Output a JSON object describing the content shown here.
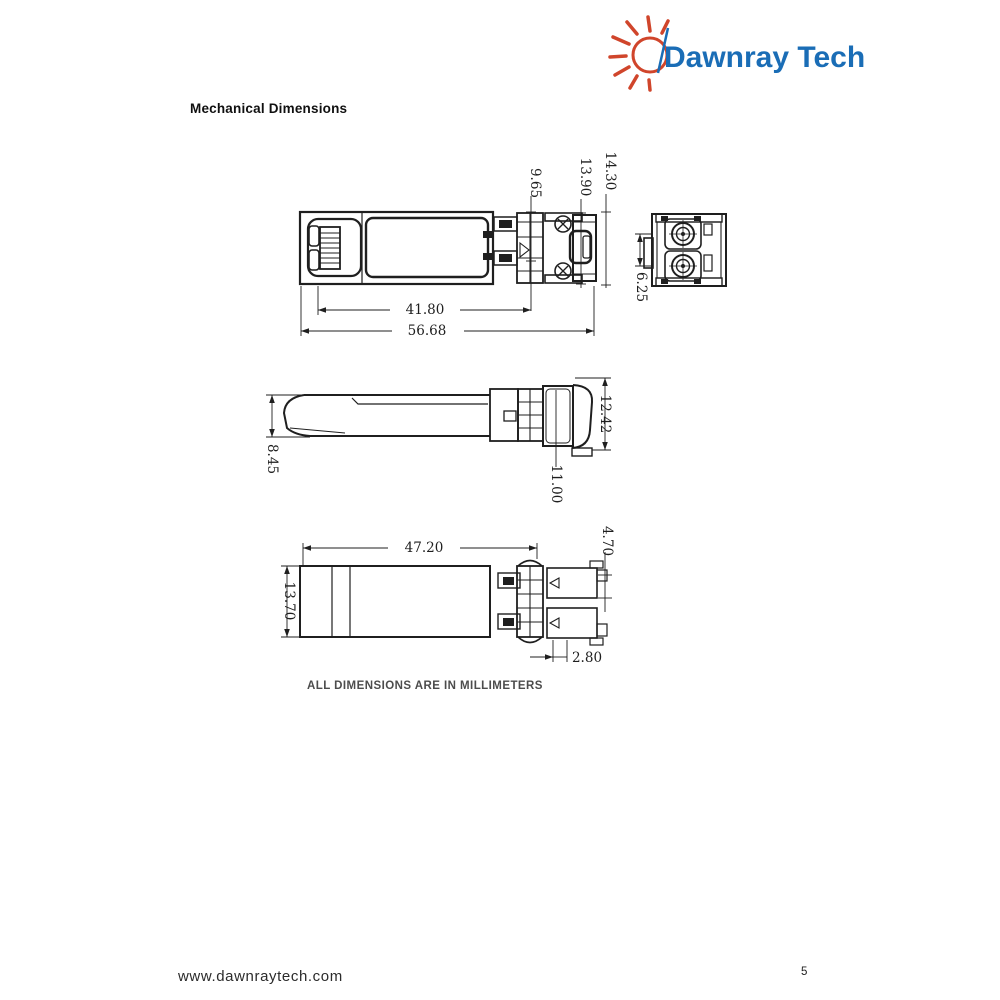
{
  "logo": {
    "brand": "Dawnray Tech"
  },
  "heading": "Mechanical Dimensions",
  "note": "ALL DIMENSIONS ARE IN MILLIMETERS",
  "footer": {
    "url": "www.dawnraytech.com",
    "page_number": "5"
  },
  "colors": {
    "brand_blue": "#1a6db6",
    "sun_red": "#d0452b",
    "drawing_line": "#1f1f1f"
  },
  "views": {
    "top": {
      "dim_front_length": "41.80",
      "dim_overall_length": "56.68",
      "dim_pad_height": "9.65",
      "dim_body_height": "13.90",
      "dim_overall_height": "14.30"
    },
    "rear": {
      "dim_ferrule_pitch": "6.25"
    },
    "side": {
      "dim_nose_height": "8.45",
      "dim_back_height": "11.00",
      "dim_latch_height": "12.42"
    },
    "bottom": {
      "dim_body_length": "47.20",
      "dim_body_width": "13.70",
      "dim_tab_height": "4.70",
      "dim_tab_offset": "2.80"
    }
  }
}
